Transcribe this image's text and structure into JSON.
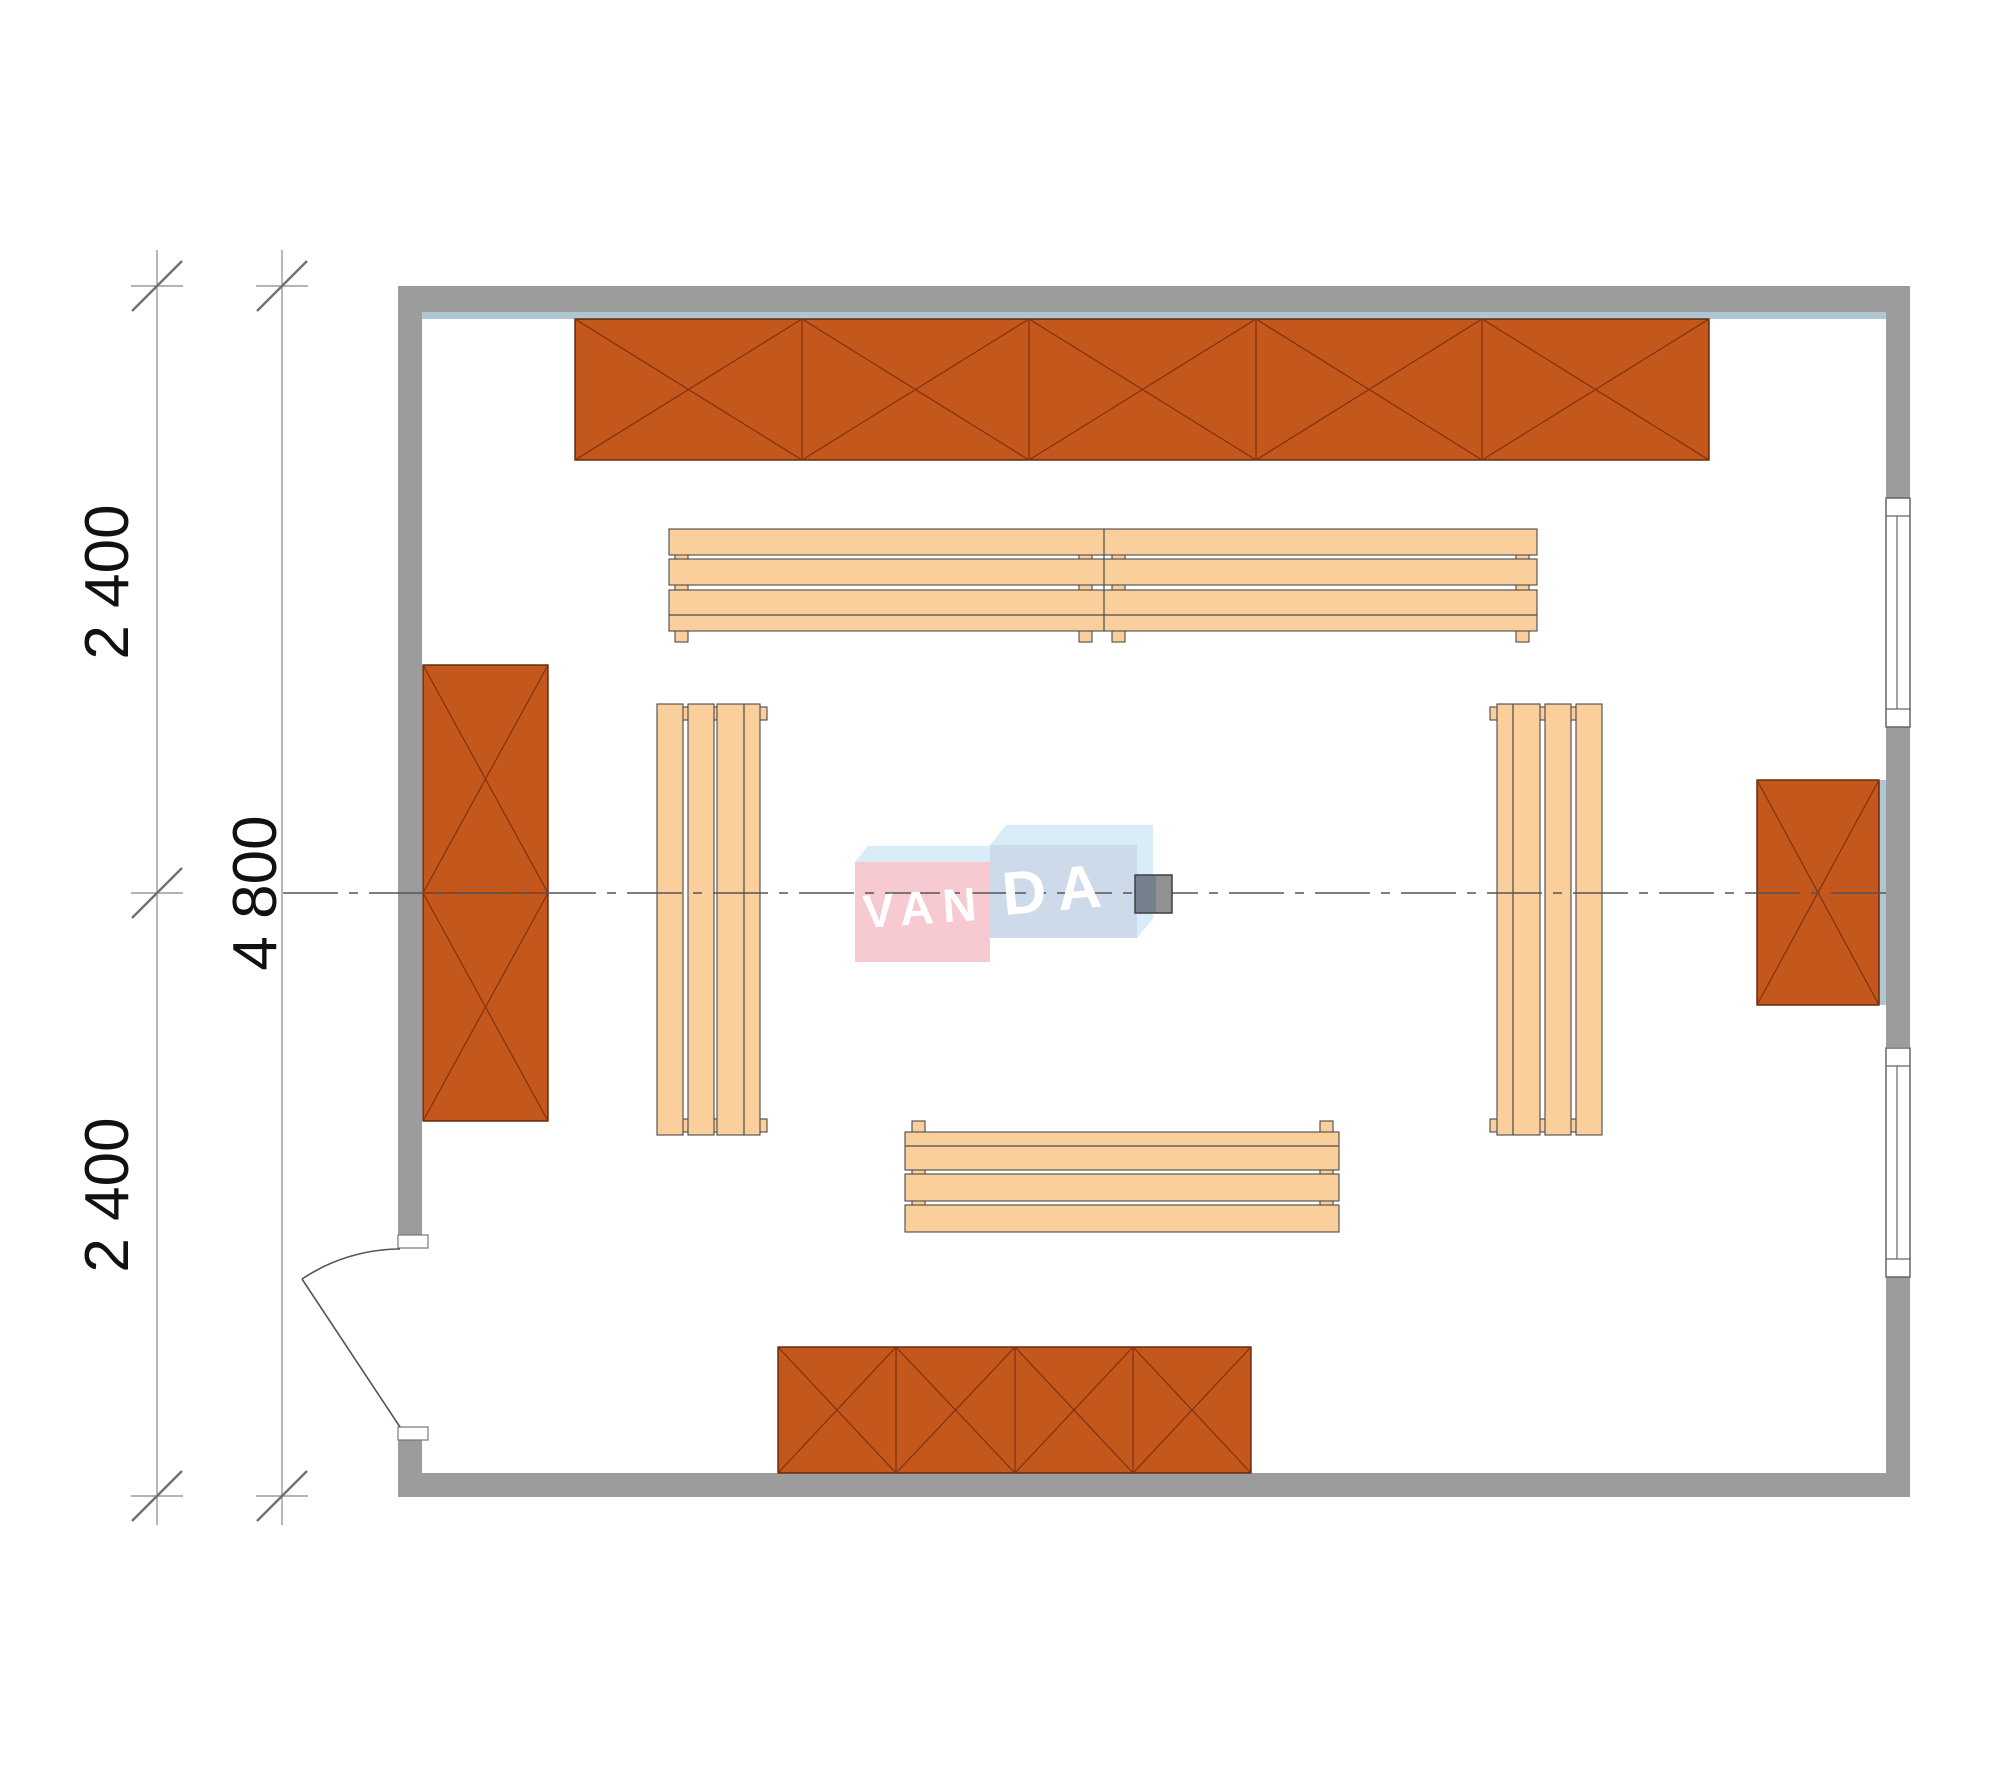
{
  "drawing": {
    "type": "architectural floor plan (sauna room, top view)",
    "dimension_labels": {
      "left_segment_top": "2 400",
      "left_segment_bottom": "2 400",
      "left_total": "4 800"
    },
    "watermark": {
      "text": "VANDA",
      "text_left": "VAN",
      "text_right": "DA"
    },
    "colors": {
      "wall": "#9C9C9C",
      "wall_lining": "#AFC7D3",
      "cabinet_fill": "#C3571C",
      "cabinet_edge": "#5E2408",
      "cabinet_cross": "#7F3210",
      "bench_fill": "#FBCF9B",
      "bench_edge": "#4A4A4A",
      "centerline": "#555555",
      "logo_pink": "#F6CAD0",
      "logo_blue_front": "#CCDAE9",
      "logo_light_blue": "#D9EDF8",
      "column_left_half": "#75828E",
      "column_right_half": "#8F9193",
      "dimension_text": "#111111"
    },
    "furniture": {
      "top_wall_cabinet_sections": 5,
      "bottom_wall_cabinet_sections": 4,
      "left_wall_cabinet_sections": 2,
      "right_wall_cabinet_sections": 1,
      "benches": [
        "top horizontal double bench",
        "bottom horizontal bench",
        "left vertical bench",
        "right vertical bench"
      ],
      "windows_on_right_wall": 2,
      "doors": 1
    }
  }
}
